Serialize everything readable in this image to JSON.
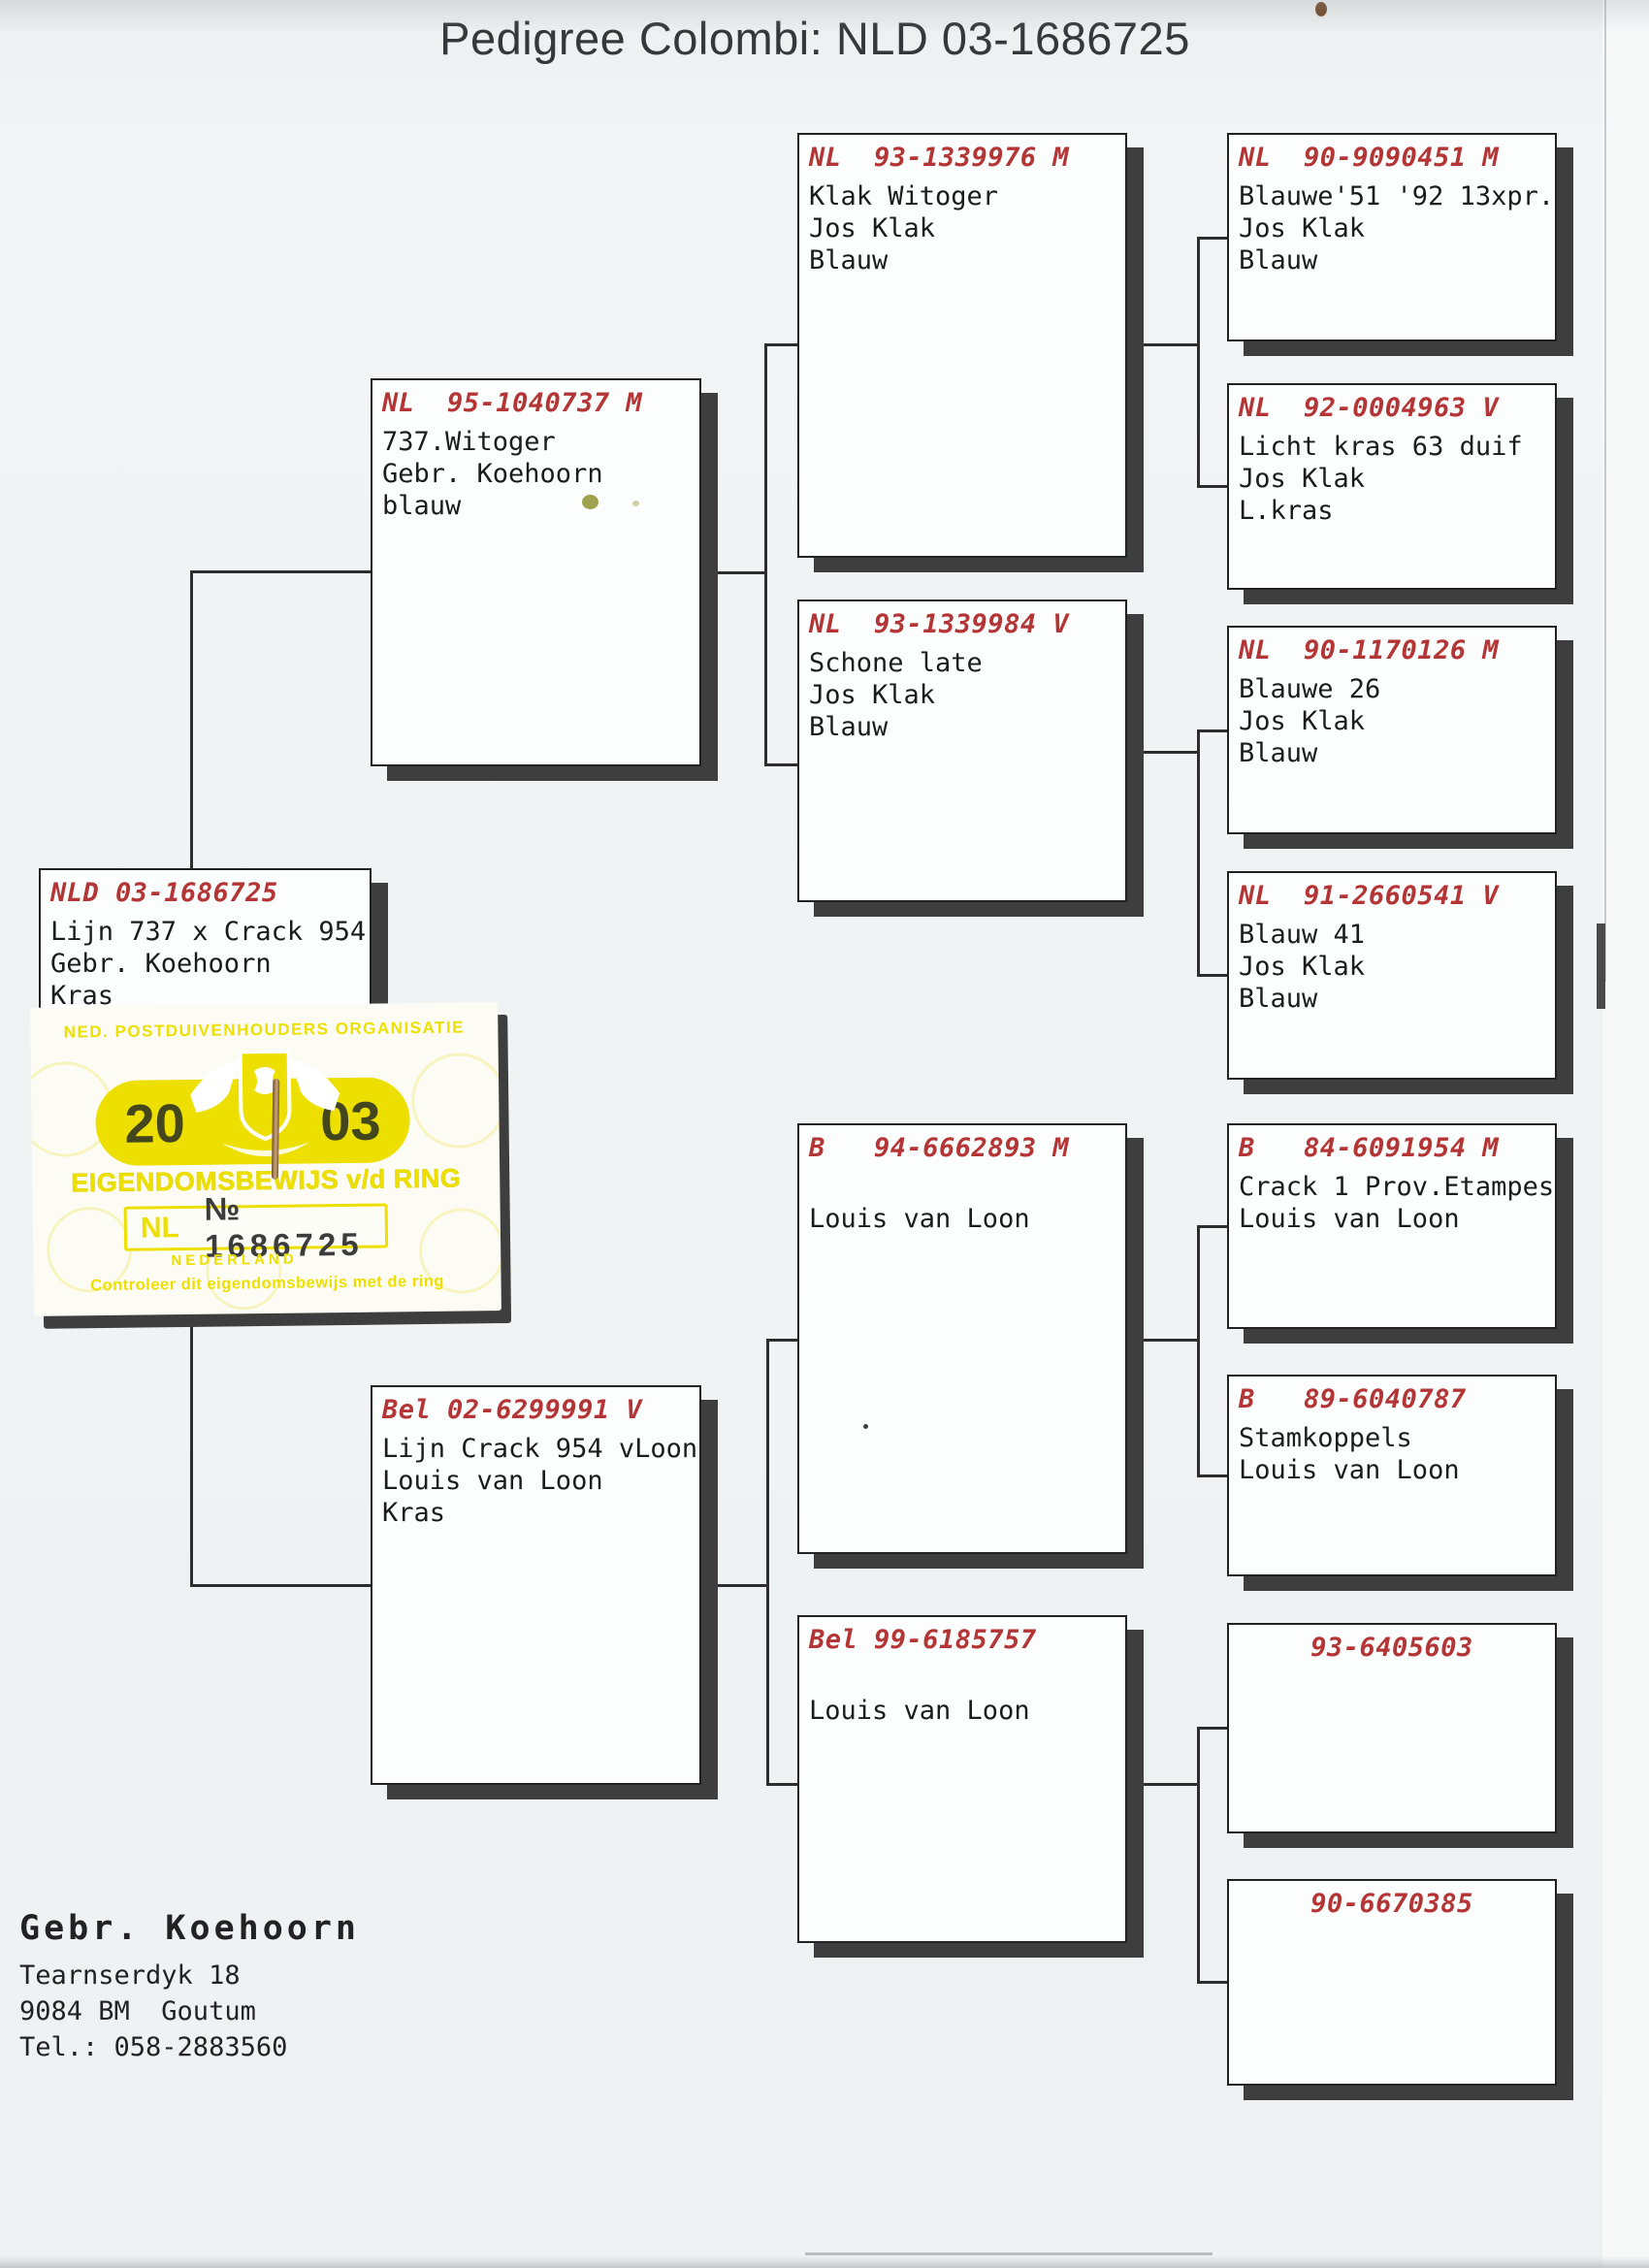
{
  "title": "Pedigree Colombi: NLD 03-1686725",
  "subject": {
    "ring": "NLD 03-1686725",
    "lines": [
      "Lijn 737 x Crack 954",
      "Gebr. Koehoorn",
      "Kras"
    ]
  },
  "parents": [
    {
      "ring": "NL  95-1040737 M",
      "lines": [
        "737.Witoger",
        "Gebr. Koehoorn",
        "blauw"
      ]
    },
    {
      "ring": "Bel 02-6299991 V",
      "lines": [
        "Lijn Crack 954 vLoon",
        "Louis van Loon",
        "Kras"
      ]
    }
  ],
  "grandparents": [
    {
      "ring": "NL  93-1339976 M",
      "lines": [
        "Klak Witoger",
        "Jos Klak",
        "Blauw"
      ]
    },
    {
      "ring": "NL  93-1339984 V",
      "lines": [
        "Schone late",
        "Jos Klak",
        "Blauw"
      ]
    },
    {
      "ring": "B   94-6662893 M",
      "lines": [
        "",
        "Louis van Loon",
        ""
      ]
    },
    {
      "ring": "Bel 99-6185757",
      "lines": [
        "",
        "Louis van Loon",
        ""
      ]
    }
  ],
  "great_grandparents": [
    {
      "ring": "NL  90-9090451 M",
      "lines": [
        "Blauwe'51 '92 13xpr.",
        "Jos Klak",
        "Blauw"
      ]
    },
    {
      "ring": "NL  92-0004963 V",
      "lines": [
        "Licht kras 63 duif",
        "Jos Klak",
        "L.kras"
      ]
    },
    {
      "ring": "NL  90-1170126 M",
      "lines": [
        "Blauwe 26",
        "Jos Klak",
        "Blauw"
      ]
    },
    {
      "ring": "NL  91-2660541 V",
      "lines": [
        "Blauw 41",
        "Jos Klak",
        "Blauw"
      ]
    },
    {
      "ring": "B   84-6091954 M",
      "lines": [
        "Crack 1 Prov.Etampes",
        "Louis van Loon",
        ""
      ]
    },
    {
      "ring": "B   89-6040787",
      "lines": [
        "Stamkoppels",
        "Louis van Loon",
        ""
      ]
    },
    {
      "ring": "93-6405603",
      "lines": [
        "",
        "",
        ""
      ]
    },
    {
      "ring": "90-6670385",
      "lines": [
        "",
        "",
        ""
      ]
    }
  ],
  "sticker": {
    "org": "NED. POSTDUIVENHOUDERS ORGANISATIE",
    "year_left": "20",
    "year_right": "03",
    "label": "EIGENDOMSBEWIJS v/d RING",
    "country": "NL",
    "ring_no": "№ 1686725",
    "nederland": "NEDERLAND",
    "footer": "Controleer dit eigendomsbewijs met de ring"
  },
  "owner": {
    "name": "Gebr. Koehoorn",
    "address1": "Tearnserdyk 18",
    "address2": "9084 BM  Goutum",
    "phone": "Tel.: 058-2883560"
  },
  "colors": {
    "header_red": "#b43535",
    "body_text": "#1c1c1c",
    "box_shadow": "#3e3e3e",
    "line": "#2e2e2e",
    "sticker_yellow": "#ede000",
    "pill_digits": "#44461e"
  }
}
